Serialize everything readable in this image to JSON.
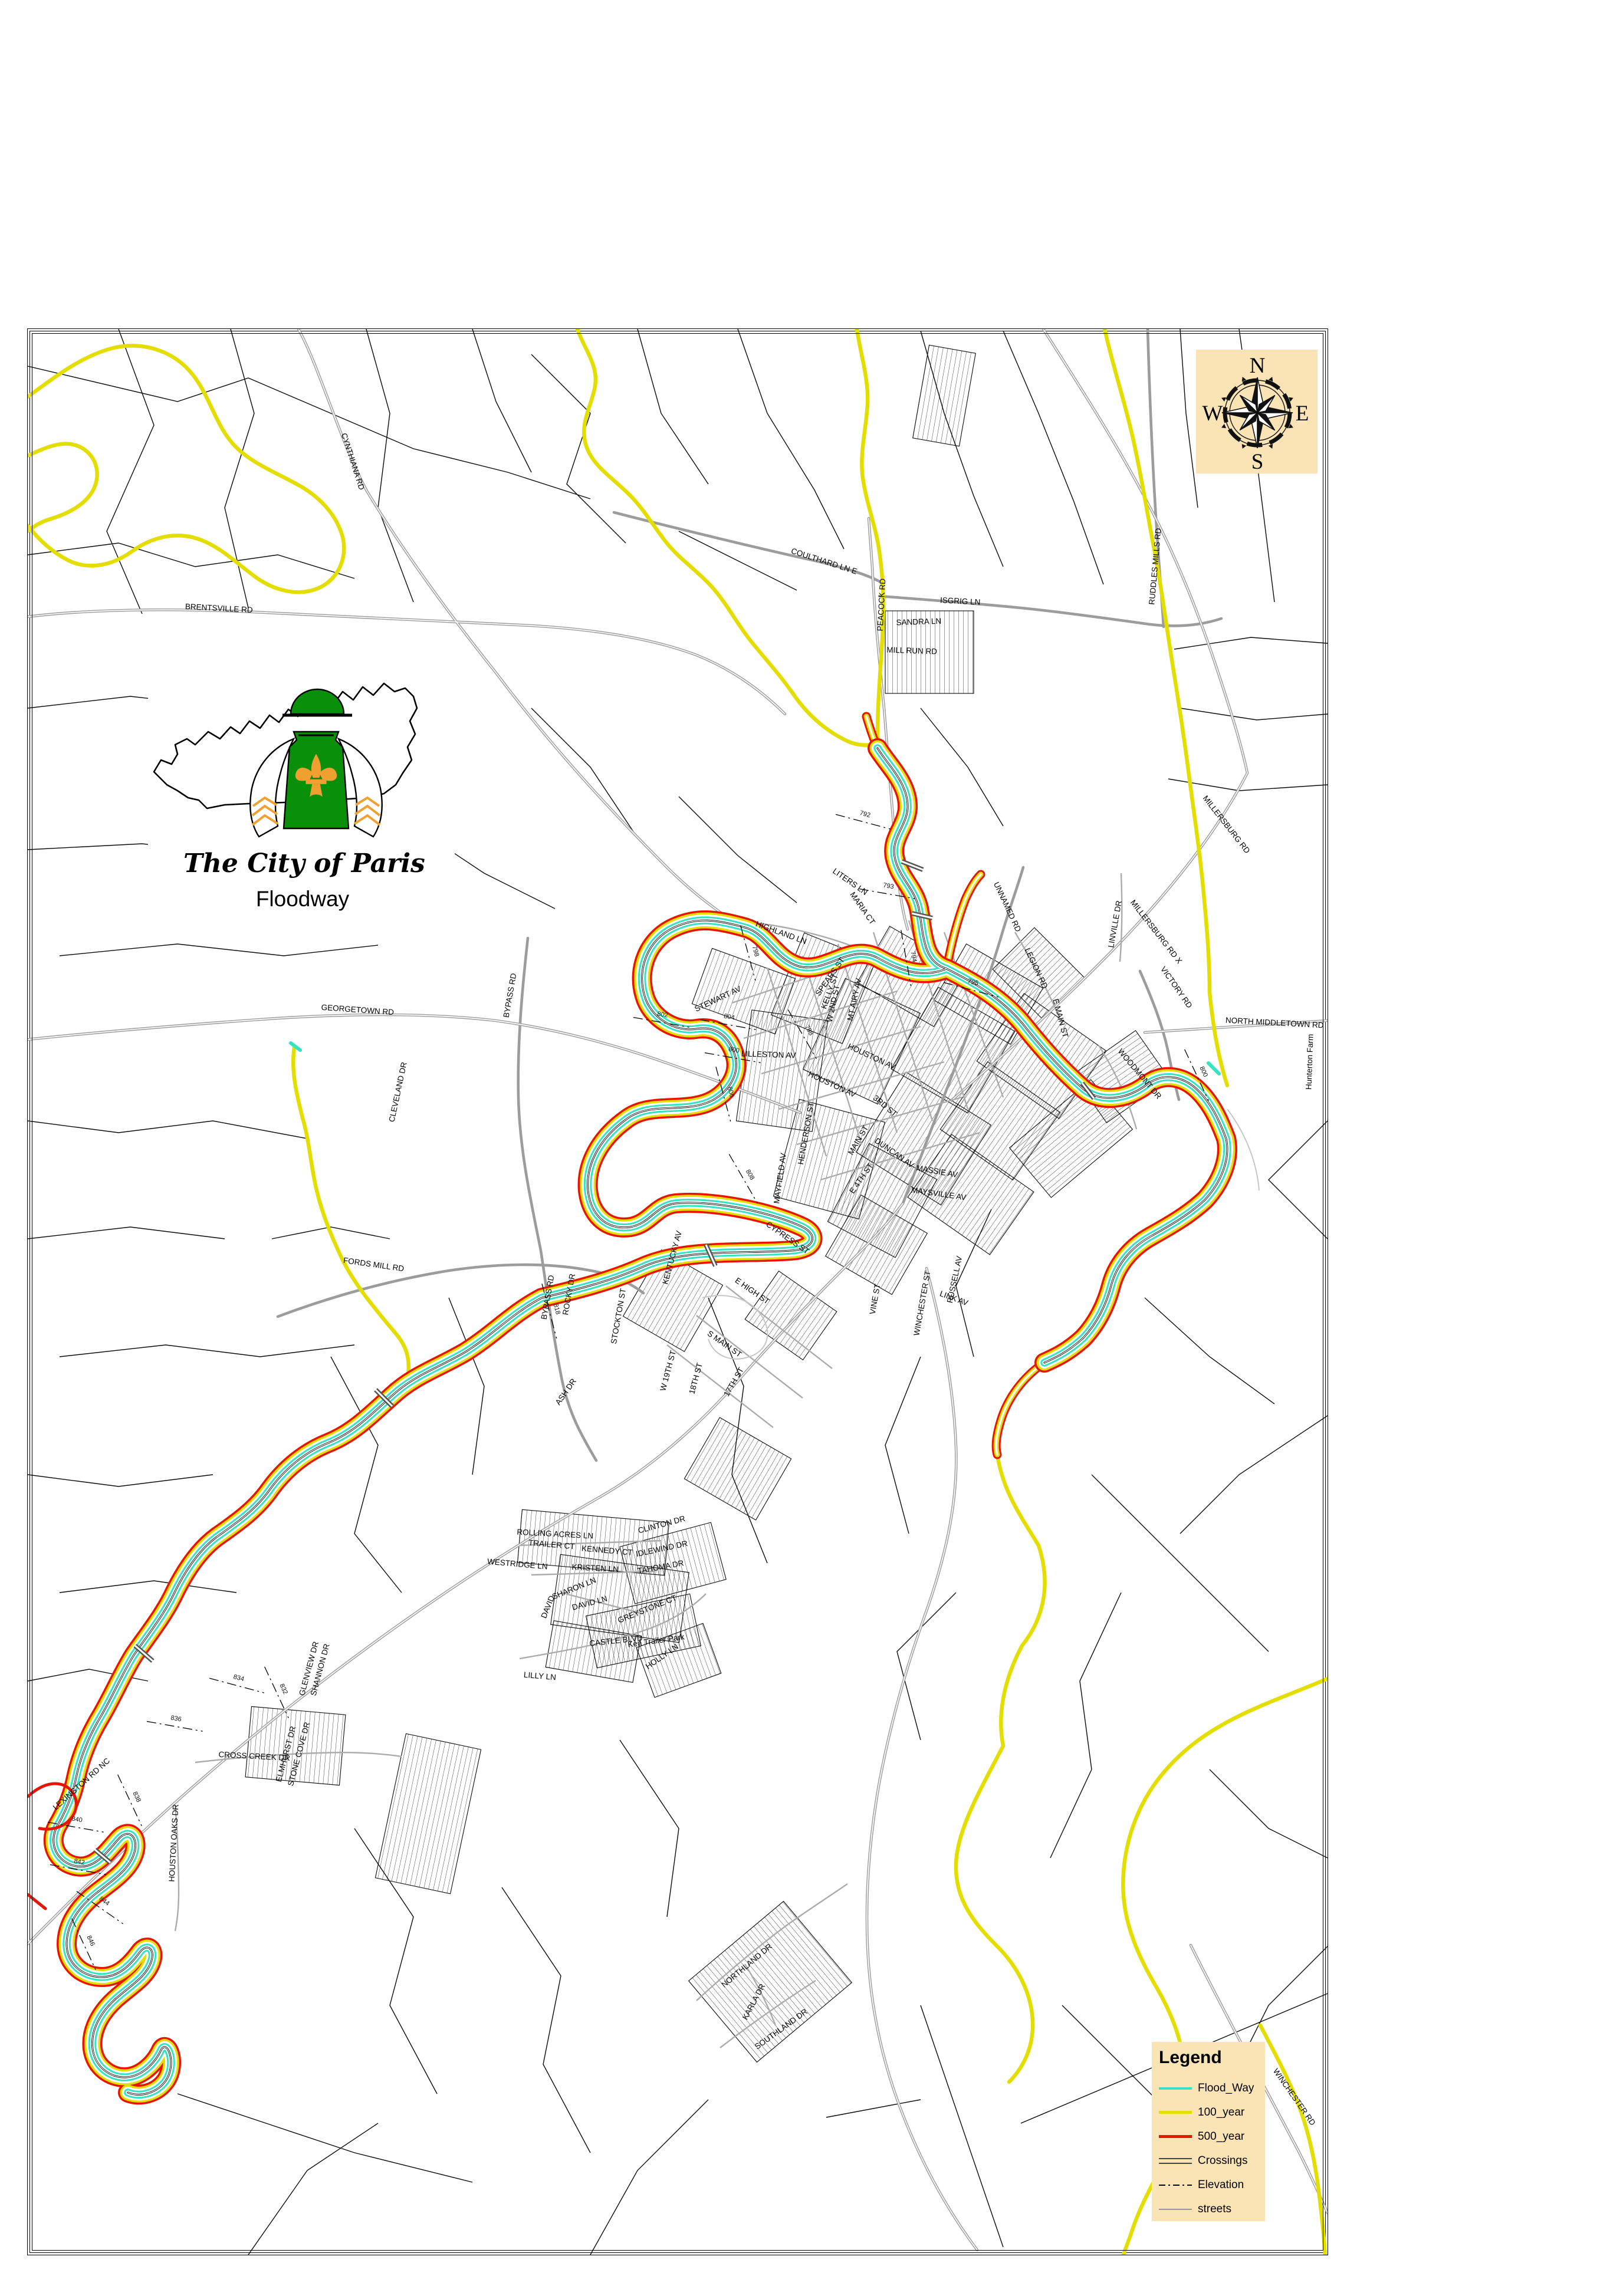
{
  "logo": {
    "title": "The City of Paris",
    "subtitle": "Floodway"
  },
  "compass": {
    "n": "N",
    "e": "E",
    "s": "S",
    "w": "W"
  },
  "legend": {
    "title": "Legend",
    "items": [
      {
        "label": "Flood_Way",
        "swatch": "floodway"
      },
      {
        "label": "100_year",
        "swatch": "year100"
      },
      {
        "label": "500_year",
        "swatch": "year500"
      },
      {
        "label": "Crossings",
        "swatch": "crossings"
      },
      {
        "label": "Elevation",
        "swatch": "elevation"
      },
      {
        "label": "streets",
        "swatch": "streets"
      }
    ]
  },
  "colors": {
    "flood": "#35E3C2",
    "y100": "#E3DE00",
    "y500": "#E81400",
    "street": "#9C9C9C",
    "panel": "#FAE3B4",
    "green": "#0A8F0A",
    "orange": "#F0A030"
  },
  "street_labels": [
    [
      "CYNTHIANA RD",
      593,
      783,
      72
    ],
    [
      "BRENTSVILLE RD",
      370,
      1035,
      3
    ],
    [
      "COULTHARD LN E",
      1395,
      955,
      18
    ],
    [
      "PEACOCK RD",
      1498,
      1025,
      -87
    ],
    [
      "ISGRIG LN",
      1627,
      1023,
      3
    ],
    [
      "SANDRA LN",
      1557,
      1058,
      -2
    ],
    [
      "MILL RUN RD",
      1545,
      1107,
      2
    ],
    [
      "RUDDLES MILLS RD",
      1962,
      960,
      -85
    ],
    [
      "MILLERSBURG RD",
      2075,
      1400,
      52
    ],
    [
      "MILLERSBURG RD X",
      1956,
      1582,
      52
    ],
    [
      "LINVILLE DR",
      1894,
      1567,
      -80
    ],
    [
      "VICTORY RD",
      1990,
      1676,
      55
    ],
    [
      "NORTH MIDDLETOWN RD",
      2160,
      1738,
      3
    ],
    [
      "WOODMONT DR",
      1928,
      1823,
      50
    ],
    [
      "Hunterton Farm",
      2224,
      1800,
      -88
    ],
    [
      "HIGHLAND LN",
      1322,
      1585,
      20
    ],
    [
      "LITERS LN",
      1438,
      1498,
      35
    ],
    [
      "MARIA CT",
      1458,
      1542,
      55
    ],
    [
      "UNNAMED RD",
      1703,
      1539,
      65
    ],
    [
      "LEGION RD",
      1752,
      1643,
      65
    ],
    [
      "E MAIN ST",
      1793,
      1727,
      75
    ],
    [
      "SPEARS ST",
      1410,
      1658,
      -55
    ],
    [
      "KELLY ST",
      1410,
      1682,
      -70
    ],
    [
      "MT AIRY AV",
      1452,
      1695,
      -78
    ],
    [
      "W 2ND ST",
      1416,
      1702,
      -78
    ],
    [
      "STEWART AV",
      1218,
      1697,
      -25
    ],
    [
      "LILLESTON AV",
      1302,
      1792,
      2
    ],
    [
      "HOUSTON AV",
      1475,
      1795,
      25
    ],
    [
      "HOUSTON AV",
      1408,
      1842,
      25
    ],
    [
      "3RD ST",
      1497,
      1878,
      40
    ],
    [
      "MAIN ST",
      1458,
      1935,
      -60
    ],
    [
      "E 4TH ST",
      1463,
      2000,
      -55
    ],
    [
      "HENDERSON ST",
      1370,
      1922,
      -80
    ],
    [
      "MAYFIELD AV",
      1326,
      1998,
      -82
    ],
    [
      "DUNCAN AV",
      1513,
      1958,
      35
    ],
    [
      "MASSIE AV",
      1587,
      1990,
      10
    ],
    [
      "MAYSVILLE AV",
      1590,
      2028,
      8
    ],
    [
      "GEORGETOWN RD",
      605,
      1716,
      4
    ],
    [
      "BYPASS RD",
      868,
      1688,
      -80
    ],
    [
      "CLEVELAND DR",
      678,
      1852,
      -78
    ],
    [
      "FORDS MILL RD",
      632,
      2148,
      8
    ],
    [
      "LEXINGTON RD NC",
      140,
      3028,
      -42
    ],
    [
      "CROSS CREEK DR",
      430,
      2982,
      3
    ],
    [
      "HOUSTON OAKS DR",
      298,
      3125,
      -87
    ],
    [
      "ELMHURST DR",
      488,
      2975,
      -75
    ],
    [
      "STONE COVE DR",
      510,
      2975,
      -75
    ],
    [
      "GLENVIEW DR",
      527,
      2830,
      -75
    ],
    [
      "SHANNON DR",
      546,
      2832,
      -75
    ],
    [
      "ROLLING ACRES LN",
      940,
      2605,
      3
    ],
    [
      "TRAILER CT",
      934,
      2623,
      5
    ],
    [
      "KENNEDY CT",
      1028,
      2633,
      5
    ],
    [
      "CLINTON DR",
      1122,
      2589,
      -15
    ],
    [
      "IDLEWIND DR",
      1122,
      2630,
      -12
    ],
    [
      "TAHOMA DR",
      1120,
      2661,
      -10
    ],
    [
      "KRISTEN LN",
      1008,
      2663,
      3
    ],
    [
      "WESTRIDGE LN",
      876,
      2656,
      5
    ],
    [
      "SHARON LN",
      974,
      2697,
      -22
    ],
    [
      "DAVID LN",
      1000,
      2722,
      -15
    ],
    [
      "DAVID",
      932,
      2726,
      -68
    ],
    [
      "GREYSTONE CT",
      1098,
      2732,
      -22
    ],
    [
      "CASTLE BLVD",
      1044,
      2786,
      -6
    ],
    [
      "Ken Trailer Park",
      1112,
      2786,
      -8
    ],
    [
      "HOLLY LN",
      1124,
      2812,
      -35
    ],
    [
      "LILLY LN",
      914,
      2846,
      5
    ],
    [
      "NORTHLAND DR",
      1268,
      3336,
      -40
    ],
    [
      "KARLA DR",
      1281,
      3396,
      -62
    ],
    [
      "SOUTHLAND DR",
      1326,
      3444,
      -36
    ],
    [
      "WINCHESTER RD",
      2190,
      3558,
      55
    ],
    [
      "BYPASS RD",
      932,
      2200,
      -80
    ],
    [
      "ROCKY DR",
      968,
      2195,
      -80
    ],
    [
      "ASH DR",
      962,
      2362,
      -55
    ],
    [
      "S MAIN ST",
      1225,
      2282,
      35
    ],
    [
      "W 19TH ST",
      1136,
      2325,
      -75
    ],
    [
      "18TH ST",
      1183,
      2338,
      -75
    ],
    [
      "17TH ST",
      1247,
      2345,
      -60
    ],
    [
      "CYPRESS ST",
      1332,
      2102,
      35
    ],
    [
      "E HIGH ST",
      1272,
      2192,
      35
    ],
    [
      "KENTUCKY AV",
      1143,
      2133,
      -75
    ],
    [
      "STOCKTON ST",
      1052,
      2232,
      -80
    ],
    [
      "VINE ST",
      1487,
      2203,
      -80
    ],
    [
      "WINCHESTER ST",
      1567,
      2210,
      -80
    ],
    [
      "LINK AV",
      1615,
      2205,
      20
    ],
    [
      "RUSSELL AV",
      1622,
      2170,
      -78
    ]
  ],
  "elevation_labels": [
    [
      "792",
      1465,
      1383,
      15
    ],
    [
      "793",
      1505,
      1505,
      10
    ],
    [
      "794",
      1545,
      1622,
      80
    ],
    [
      "795",
      1648,
      1668,
      15
    ],
    [
      "798",
      1277,
      1613,
      75
    ],
    [
      "798",
      1368,
      1748,
      60
    ],
    [
      "800",
      1243,
      1783,
      10
    ],
    [
      "800",
      2037,
      1818,
      65
    ],
    [
      "802",
      1122,
      1723,
      10
    ],
    [
      "804",
      1235,
      1727,
      10
    ],
    [
      "806",
      1235,
      1852,
      75
    ],
    [
      "808",
      1268,
      1993,
      60
    ],
    [
      "818",
      940,
      2220,
      75
    ],
    [
      "832",
      477,
      2865,
      65
    ],
    [
      "834",
      403,
      2848,
      15
    ],
    [
      "836",
      297,
      2917,
      10
    ],
    [
      "838",
      228,
      3048,
      65
    ],
    [
      "840",
      129,
      3088,
      10
    ],
    [
      "842",
      133,
      3160,
      10
    ],
    [
      "844",
      174,
      3226,
      35
    ],
    [
      "846",
      150,
      3292,
      65
    ]
  ]
}
